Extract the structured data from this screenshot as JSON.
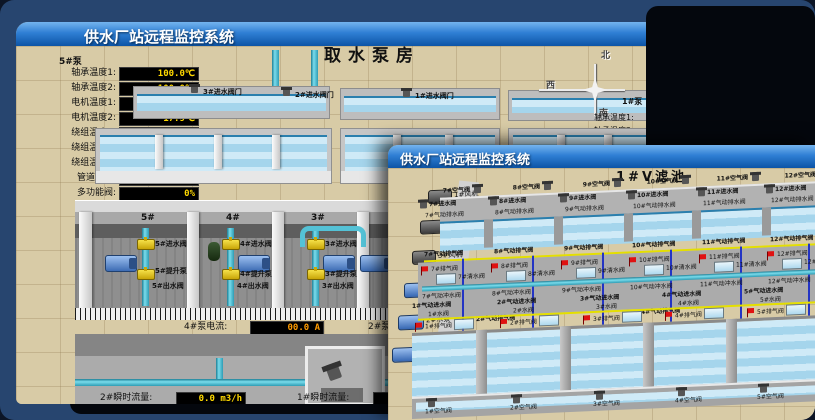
{
  "back_window": {
    "title": "供水厂站远程监控系统",
    "scene_title": "取水泵房",
    "left_panel": {
      "title": "5#泵",
      "rows": [
        {
          "label": "轴承温度1:",
          "value": "100.0℃"
        },
        {
          "label": "轴承温度2:",
          "value": "100.0℃"
        },
        {
          "label": "电机温度1:",
          "value": "18.1℃"
        },
        {
          "label": "电机温度2:",
          "value": "17.9℃"
        },
        {
          "label": "绕组温度1:",
          "value": "18.0℃"
        },
        {
          "label": "绕组温度2:",
          "value": "18.1℃"
        },
        {
          "label": "绕组温度3:",
          "value": "18.1℃"
        },
        {
          "label": "管道压力:",
          "value": "0.0007MPa"
        },
        {
          "label": "多功能阀:",
          "value": "0%"
        }
      ]
    },
    "compass": {
      "north": "北",
      "south": "南",
      "west": "西",
      "east": "东"
    },
    "intake_valves": [
      "3#进水阀门",
      "2#进水阀门",
      "1#进水阀门"
    ],
    "right_panel": {
      "title": "1#泵",
      "rows": [
        "轴承温度1:",
        "轴承温度2:"
      ]
    },
    "bays": [
      {
        "no": "5#",
        "inlet": "5#进水阀",
        "pump": "5#提升泵",
        "outlet": "5#出水阀"
      },
      {
        "no": "4#",
        "inlet": "4#进水阀",
        "pump": "4#提升泵",
        "outlet": "4#出水阀"
      },
      {
        "no": "3#",
        "inlet": "3#进水阀",
        "pump": "3#提升泵",
        "outlet": "3#出水阀"
      },
      {
        "no": "2#",
        "inlet": "2#进水阀",
        "pump": "2#提升泵",
        "outlet": "2#出水阀"
      }
    ],
    "current": {
      "left_label": "4#泵电流:",
      "left_value": "00.0 A",
      "right_label": "2#泵电流:"
    },
    "flow": {
      "left_label": "2#瞬时流量:",
      "left_value": "0.0 m3/h",
      "right_label": "1#瞬时流量:",
      "right_value": "0.0 m3/h"
    }
  },
  "front_window": {
    "title": "供水厂站远程监控系统",
    "scene_title": "1#V滤池",
    "equipment": [
      {
        "label": "1#风机"
      },
      {
        "label": "2#风机"
      },
      {
        "label": "3#风机"
      },
      {
        "label": "1#水泵"
      },
      {
        "label": "2#水泵"
      },
      {
        "label": "3#水泵"
      }
    ],
    "top_cells": [
      {
        "air": "7#空气阀",
        "inlet": "7#进水阀",
        "drain": "7#气动排水阀",
        "vent": "7#气动排气阀",
        "flag": "7#排气阀",
        "clean": "7#清水阀",
        "flush": "7#气动冲水阀"
      },
      {
        "air": "8#空气阀",
        "inlet": "8#进水阀",
        "drain": "8#气动排水阀",
        "vent": "8#气动排气阀",
        "flag": "8#排气阀",
        "clean": "8#清水阀",
        "flush": "8#气动冲水阀"
      },
      {
        "air": "9#空气阀",
        "inlet": "9#进水阀",
        "drain": "9#气动排水阀",
        "vent": "9#气动排气阀",
        "flag": "9#排气阀",
        "clean": "9#清水阀",
        "flush": "9#气动冲水阀"
      },
      {
        "air": "10#空气阀",
        "inlet": "10#进水阀",
        "drain": "10#气动排水阀",
        "vent": "10#气动排气阀",
        "flag": "10#排气阀",
        "clean": "10#清水阀",
        "flush": "10#气动冲水阀"
      },
      {
        "air": "11#空气阀",
        "inlet": "11#进水阀",
        "drain": "11#气动排水阀",
        "vent": "11#气动排气阀",
        "flag": "11#排气阀",
        "clean": "11#清水阀",
        "flush": "11#气动冲水阀"
      },
      {
        "air": "12#空气阀",
        "inlet": "12#进水阀",
        "drain": "12#气动排水阀",
        "vent": "12#气动排气阀",
        "flag": "12#排气阀",
        "clean": "12#清水阀",
        "flush": "12#气动冲水阀"
      }
    ],
    "bottom_cells": [
      {
        "feed": "1#气动进水阀",
        "wvalve": "1#水阀",
        "vent": "1#气动排气阀",
        "flag": "1#排气阀",
        "air": "1#空气阀"
      },
      {
        "feed": "2#气动进水阀",
        "wvalve": "2#水阀",
        "vent": "2#气动排气阀",
        "flag": "2#排气阀",
        "air": "2#空气阀"
      },
      {
        "feed": "3#气动进水阀",
        "wvalve": "3#水阀",
        "vent": "3#气动排气阀",
        "flag": "3#排气阀",
        "air": "3#空气阀"
      },
      {
        "feed": "4#气动进水阀",
        "wvalve": "4#水阀",
        "vent": "4#气动排气阀",
        "flag": "4#排气阀",
        "air": "4#空气阀"
      },
      {
        "feed": "5#气动进水阀",
        "wvalve": "5#水阀",
        "vent": "5#气动排气阀",
        "flag": "5#排气阀",
        "air": "5#空气阀"
      }
    ]
  }
}
